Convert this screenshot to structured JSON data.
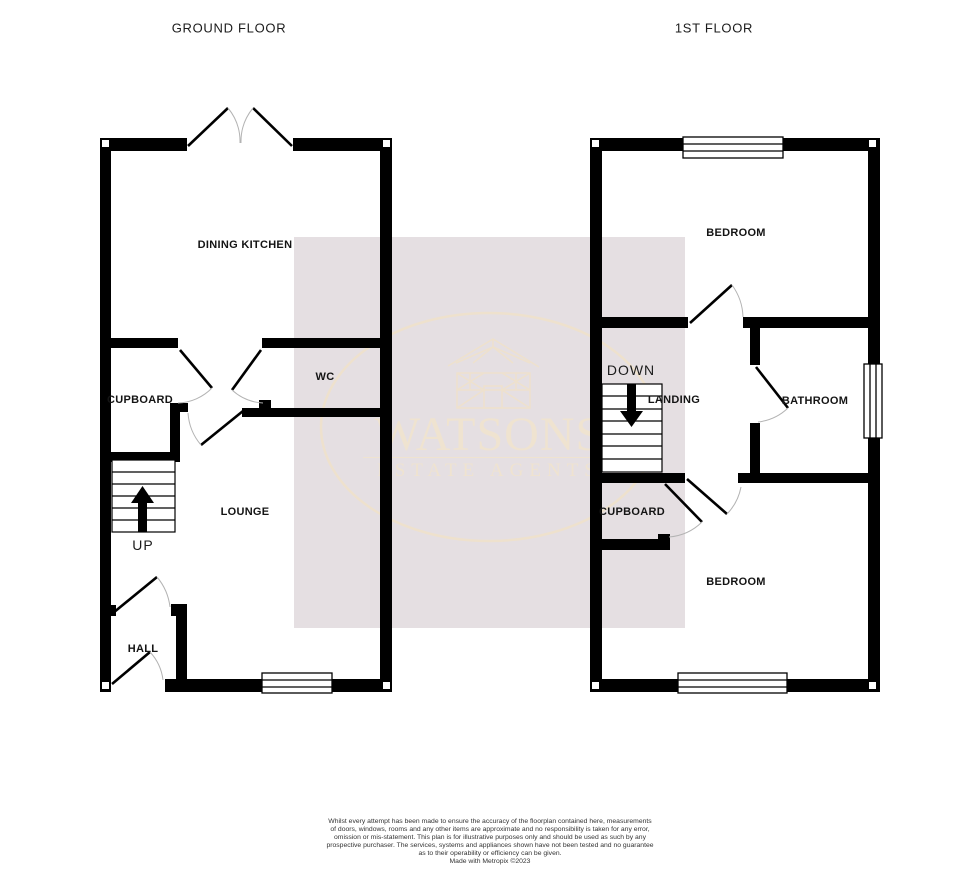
{
  "page": {
    "background_color": "#ffffff",
    "wall_color": "#000000",
    "door_arc_color": "#b3b3b3"
  },
  "titles": {
    "ground_floor": "GROUND FLOOR",
    "first_floor": "1ST FLOOR"
  },
  "ground_floor": {
    "labels": {
      "dining_kitchen": "DINING KITCHEN",
      "wc": "WC",
      "cupboard": "CUPBOARD",
      "lounge": "LOUNGE",
      "up": "UP",
      "hall": "HALL"
    }
  },
  "first_floor": {
    "labels": {
      "bedroom_front": "BEDROOM",
      "down": "DOWN",
      "landing": "LANDING",
      "bathroom": "BATHROOM",
      "cupboard": "CUPBOARD",
      "bedroom_back": "BEDROOM"
    }
  },
  "watermark": {
    "name": "WATSONS",
    "tagline": "ESTATE AGENTS",
    "icon": "house-logo-icon",
    "square_color": "#e5dfe2",
    "accent_color": "#efe3d0"
  },
  "disclaimer": {
    "l1": "Whilst every attempt has been made to ensure the accuracy of the floorplan contained here, measurements",
    "l2": "of doors, windows, rooms and any other items are approximate and no responsibility is taken for any error,",
    "l3": "omission or mis-statement. This plan is for illustrative purposes only and should be used as such by any",
    "l4": "prospective purchaser. The services, systems and appliances shown have not been tested and no guarantee",
    "l5": "as to their operability or efficiency can be given.",
    "credit": "Made with Metropix ©2023"
  }
}
